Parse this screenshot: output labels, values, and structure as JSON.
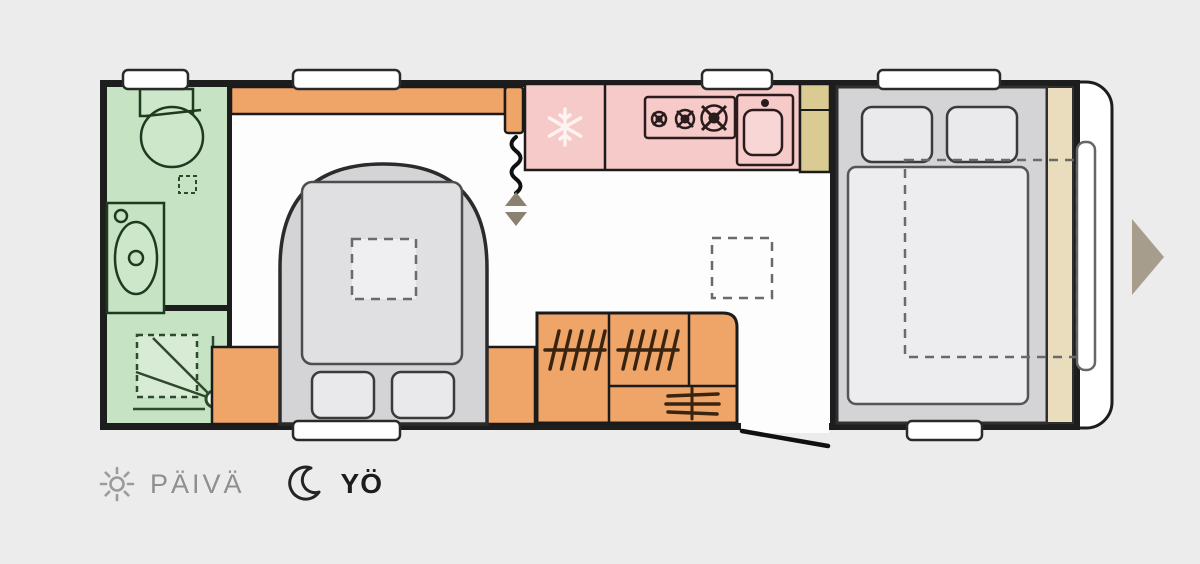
{
  "colors": {
    "background": "#ececec",
    "floor": "#fdfdfd",
    "wall": "#1d1d1d",
    "bathroom_green": "#c6e3c4",
    "kitchen_pink": "#f7caca",
    "furniture_orange": "#efa568",
    "bed_gray": "#d4d4d6",
    "wardrobe_tan": "#d9cb92",
    "headboard_tan": "#e9ddbe",
    "arrow_taupe": "#a69d8c",
    "legend_inactive": "#8f8f8f",
    "legend_active": "#1c1c1c"
  },
  "legend": {
    "day": {
      "label": "PÄIVÄ",
      "icon": "sun-icon",
      "active": false
    },
    "night": {
      "label": "YÖ",
      "icon": "moon-icon",
      "active": true
    }
  },
  "carousel": {
    "next_icon": "triangle-right-arrow"
  },
  "floorplan": {
    "kind": "caravan floor plan, night (yö) configuration",
    "areas": [
      "bathroom",
      "shower-room",
      "lounge-made-up-bed",
      "kitchen",
      "wardrobe",
      "rear-double-bedroom"
    ],
    "fixtures": [
      "toilet",
      "washbasin",
      "shower-tray",
      "roof-vent-marker",
      "overhead-locker-band",
      "dinette-double-bed",
      "folding-table-marker",
      "fridge (snowflake-icon)",
      "hob-3-burners",
      "kitchen-sink",
      "heater (coil-icon)",
      "entry-step (up-down-triangle-icons)",
      "wardrobe-hanging-rails (hanger-hatch-icon)",
      "drawer-stack (shelf-lines-icon)",
      "entry-door (door-swing-line)",
      "fixed-double-bed",
      "pillows",
      "bed-extension (dashed-outline)",
      "front-window",
      "roof-windows"
    ]
  }
}
